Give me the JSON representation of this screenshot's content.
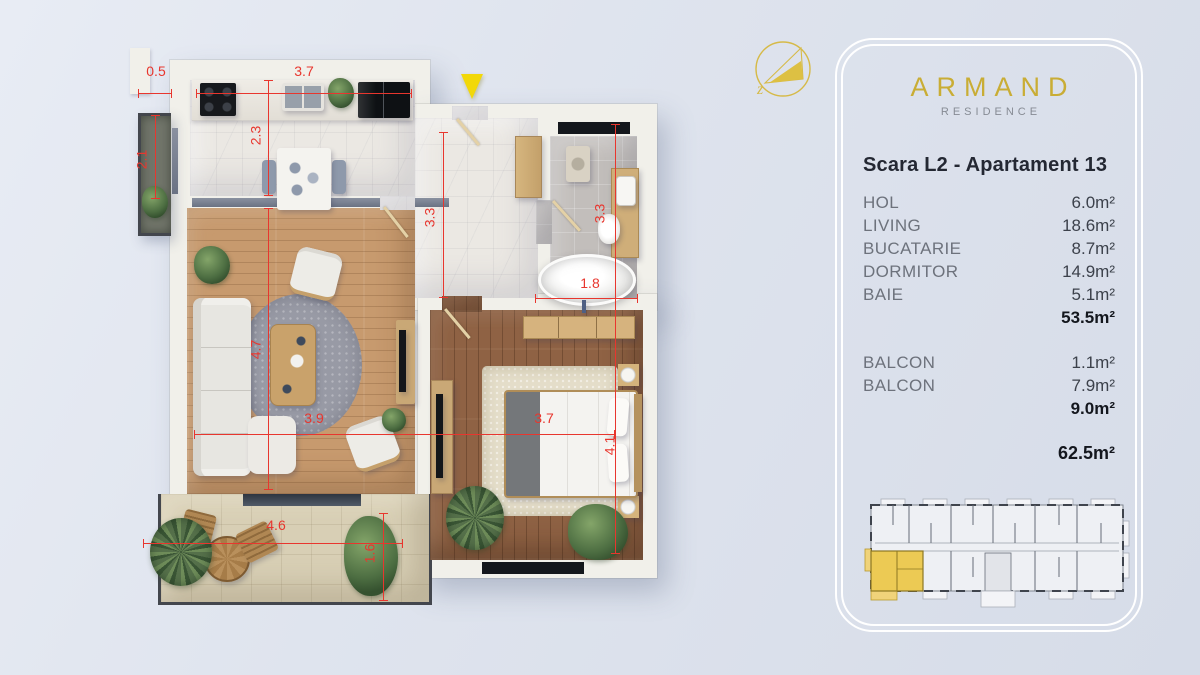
{
  "branding": {
    "name": "ARMAND",
    "subtitle": "RESIDENCE"
  },
  "panel": {
    "title": "Scara L2 - Apartament 13",
    "rooms": [
      {
        "label": "HOL",
        "area": "6.0m²"
      },
      {
        "label": "LIVING",
        "area": "18.6m²"
      },
      {
        "label": "BUCATARIE",
        "area": "8.7m²"
      },
      {
        "label": "DORMITOR",
        "area": "14.9m²"
      },
      {
        "label": "BAIE",
        "area": "5.1m²"
      }
    ],
    "rooms_total": "53.5m²",
    "balconies": [
      {
        "label": "BALCON",
        "area": "1.1m²"
      },
      {
        "label": "BALCON",
        "area": "7.9m²"
      }
    ],
    "balconies_total": "9.0m²",
    "grand_total": "62.5m²"
  },
  "compass": {
    "letter": "z"
  },
  "floorplan": {
    "dimensions": {
      "kitchen_offset": "0.5",
      "kitchen_width": "3.7",
      "kitchen_depth": "2.3",
      "balcony_left_height": "2.1",
      "hall_depth": "3.3",
      "bath_depth": "3.3",
      "bath_width": "1.8",
      "living_depth": "4.7",
      "living_width": "3.9",
      "bedroom_width": "3.7",
      "bedroom_depth": "4.1",
      "terrace_width": "4.6",
      "terrace_depth": "1.6"
    },
    "colors": {
      "dimension_red": "#e8362e",
      "entrance_arrow": "#f2d808",
      "brand_gold": "#c9ad35",
      "highlight_unit": "#ecca54"
    }
  }
}
